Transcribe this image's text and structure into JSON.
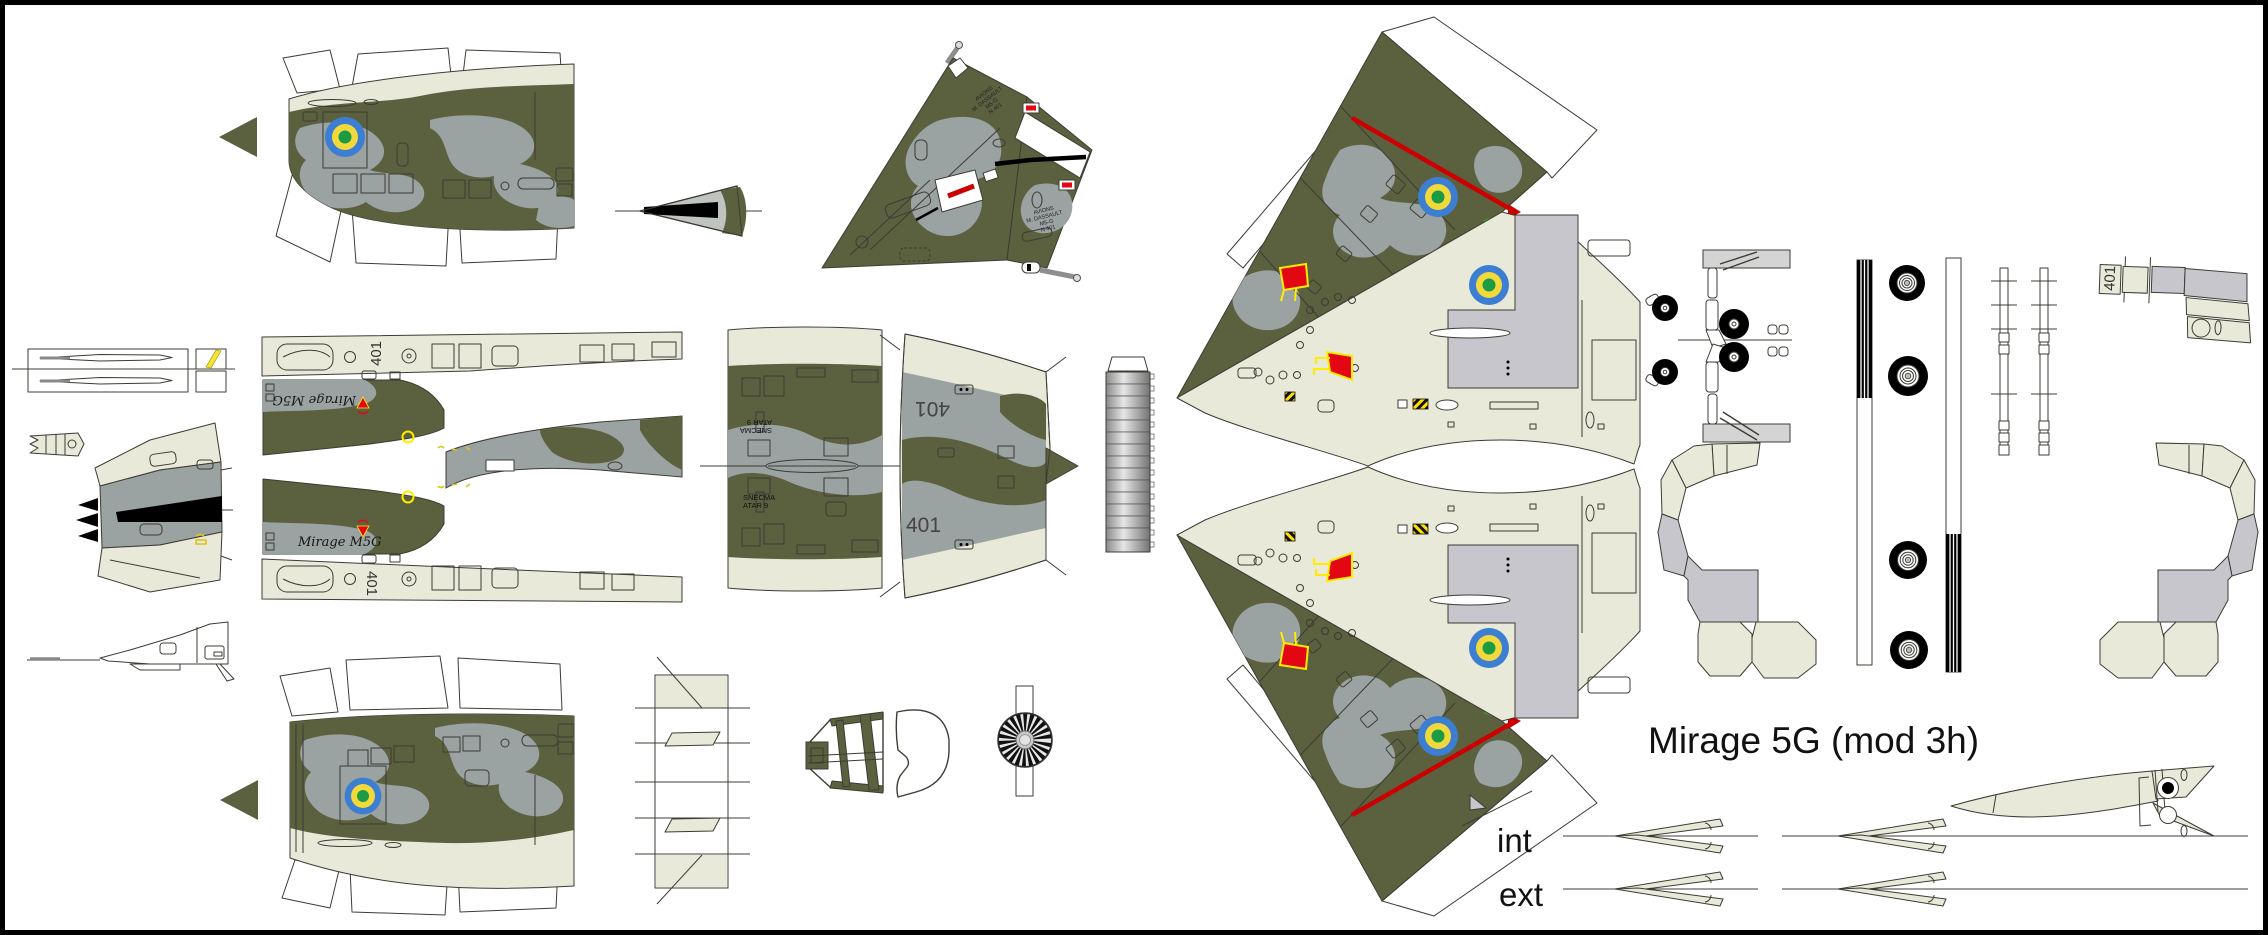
{
  "title": "Mirage 5G (mod 3h)",
  "labels": {
    "aircraft_number": "401",
    "fuselage_script": "Mirage M5G",
    "engine_text_lines": [
      "SNECMA",
      "ATAR 9"
    ],
    "tail_text_lines": [
      "AVIONS",
      "M. DASSAULT",
      "M5-G",
      "N 401"
    ],
    "pylon_inner": "int",
    "pylon_outer": "ext"
  },
  "colors": {
    "outline": "#3c3c34",
    "cream": "#e9e9da",
    "olive": "#5b603f",
    "camo-gray": "#9aa2a2",
    "panel-gray": "#c6c6cc",
    "light-gray": "#d4d4d4",
    "roundel-blue": "#3b7ed2",
    "roundel-yellow": "#f2d93b",
    "roundel-green": "#1d9a44",
    "red": "#e30613",
    "stripe-red": "#cc0000",
    "yellow": "#ffec00",
    "canopy-blue": "#bcdcf2",
    "black": "#000000"
  },
  "parts": [
    {
      "name": "fuselage-nose-side-top",
      "description": "Forward fuselage side skin with roundel, upper copy"
    },
    {
      "name": "fuselage-nose-side-bottom",
      "description": "Forward fuselage side skin with roundel, lower copy"
    },
    {
      "name": "direction-arrow",
      "description": "Assembly direction arrow"
    },
    {
      "name": "nose-cone",
      "description": "Small nose cone wrap"
    },
    {
      "name": "tail-fin",
      "description": "Vertical tail fin halves with squadron text"
    },
    {
      "name": "forward-fuselage-spread",
      "description": "Fuselage top/bottom spread with canopy strips and 401 codes"
    },
    {
      "name": "mid-fuselage-a",
      "description": "Mid fuselage wrap with SNECMA ATAR 9 markings"
    },
    {
      "name": "mid-fuselage-b",
      "description": "Rear fuselage wrap with 401 codes"
    },
    {
      "name": "exhaust-nozzle-strip",
      "description": "Segmented exhaust nozzle strip"
    },
    {
      "name": "wing-upper",
      "description": "Upper wing panel, camouflage and underside"
    },
    {
      "name": "wing-lower",
      "description": "Lower wing panel, mirror copy"
    },
    {
      "name": "landing-gear-assembly",
      "description": "Nose and main gear legs with wheels"
    },
    {
      "name": "wheel-strips",
      "description": "Wheel tread strips and four main wheels"
    },
    {
      "name": "gear-strut-strips",
      "description": "Thin strut strips with crossbars"
    },
    {
      "name": "gear-door-401",
      "description": "Gear door part labelled 401"
    },
    {
      "name": "intake-duct-left",
      "description": "Left intake duct unfold"
    },
    {
      "name": "intake-duct-right",
      "description": "Right intake duct unfold"
    },
    {
      "name": "drop-tank",
      "description": "Drop tank profile with tail fins"
    },
    {
      "name": "pylon-row-int",
      "description": "Inner pylon pairs row"
    },
    {
      "name": "pylon-row-ext",
      "description": "Outer pylon pairs row"
    },
    {
      "name": "formers-strip",
      "description": "Former/bulkhead layout strip"
    },
    {
      "name": "canopy-glass",
      "description": "Windshield and canopy glazing"
    },
    {
      "name": "engine-fan",
      "description": "Engine compressor face disc"
    },
    {
      "name": "pitot-box",
      "description": "Boxed pitot probe parts"
    },
    {
      "name": "yellow-marker-squares",
      "description": "Yellow marking squares"
    },
    {
      "name": "nose-cone-unfold",
      "description": "Radome fan-shaped unfold"
    },
    {
      "name": "nose-profile",
      "description": "Nose side profile former"
    },
    {
      "name": "striped-wedge",
      "description": "Small striped wedge part"
    }
  ]
}
